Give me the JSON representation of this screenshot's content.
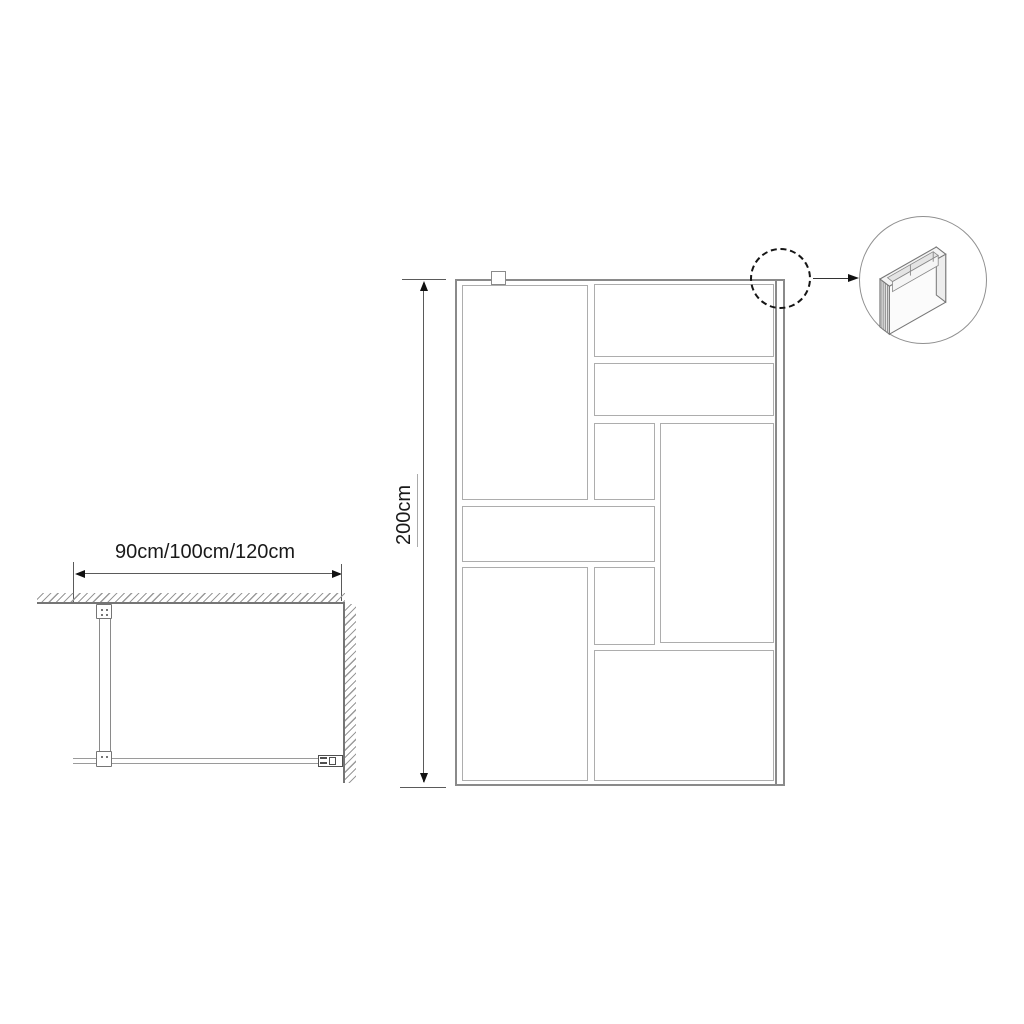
{
  "colors": {
    "background": "#ffffff",
    "text": "#1a1a1a",
    "line_dark": "#111111",
    "dim_line": "#5a5a5a",
    "frame_line": "#8a8a8a",
    "pane_line": "#adadad",
    "wall_line": "#757575",
    "hatch_line": "#9a9a9a",
    "glass_line": "#9a9a9a"
  },
  "plan_view": {
    "width_label": "90cm/100cm/120cm",
    "parts": [
      "ceiling-wall-hatch",
      "side-wall-hatch",
      "support-bar",
      "ceiling-bracket",
      "glass-clamp",
      "glass-panel-line",
      "wall-connector"
    ]
  },
  "front_view": {
    "height_label": "200cm",
    "pane_count": 9,
    "panes": [
      {
        "x": 462,
        "y": 285,
        "w": 126,
        "h": 215
      },
      {
        "x": 594,
        "y": 284,
        "w": 180,
        "h": 73
      },
      {
        "x": 594,
        "y": 363,
        "w": 180,
        "h": 53
      },
      {
        "x": 594,
        "y": 423,
        "w": 61,
        "h": 77
      },
      {
        "x": 660,
        "y": 423,
        "w": 114,
        "h": 220
      },
      {
        "x": 462,
        "y": 506,
        "w": 193,
        "h": 56
      },
      {
        "x": 462,
        "y": 567,
        "w": 126,
        "h": 214
      },
      {
        "x": 594,
        "y": 567,
        "w": 61,
        "h": 78
      },
      {
        "x": 594,
        "y": 650,
        "w": 180,
        "h": 131
      }
    ],
    "parts": [
      "panel-frame",
      "wall-profile-strip",
      "support-bracket-tab"
    ]
  },
  "detail": {
    "parts": [
      "detail-dashed-circle",
      "callout-arrow",
      "detail-circle",
      "wall-profile-3d"
    ]
  }
}
